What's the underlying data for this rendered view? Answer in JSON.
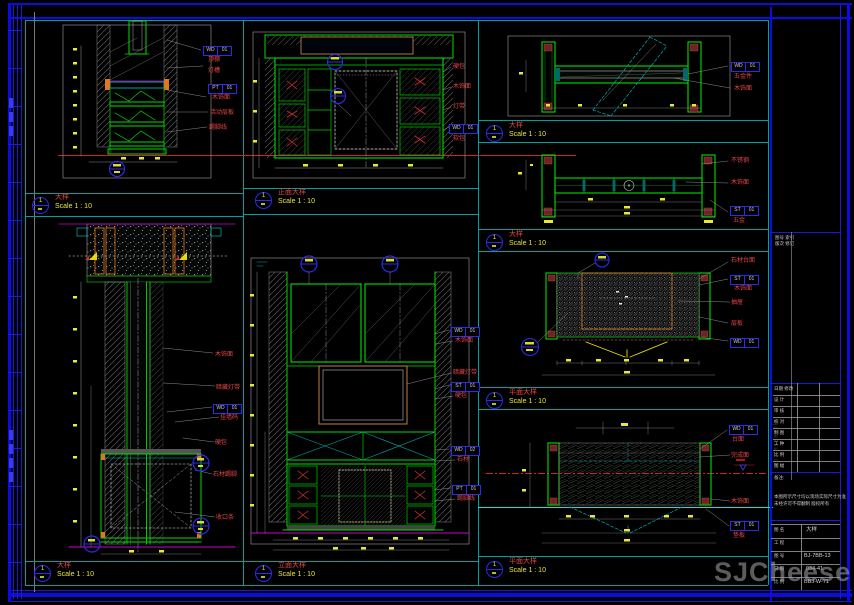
{
  "watermark": {
    "text": "SJCheese",
    "vertical_text": "sjcheese.com"
  },
  "drawings": {
    "d1": {
      "num": "1",
      "title": "大样",
      "scale": "Scale 1 : 10",
      "annotations": [
        "顶棚",
        "灯槽",
        "木饰面",
        "活动层板",
        "踢脚线"
      ],
      "tags": [
        [
          "WD",
          "01"
        ],
        [
          "PT",
          "01"
        ]
      ]
    },
    "d2": {
      "num": "1",
      "title": "大样",
      "scale": "Scale 1 : 10",
      "annotations": [
        "木饰面",
        "暗藏灯带",
        "挂墙码",
        "硬包",
        "石材踢脚",
        "收口条"
      ],
      "tags": [
        [
          "WD",
          "01"
        ]
      ]
    },
    "d3": {
      "num": "1",
      "title": "正面大样",
      "scale": "Scale 1 : 10",
      "annotations": [
        "硬包",
        "木饰面",
        "灯带",
        "软包"
      ],
      "tags": [
        [
          "WD",
          "01"
        ]
      ]
    },
    "d4": {
      "num": "1",
      "title": "立面大样",
      "scale": "Scale 1 : 10",
      "annotations": [
        "木饰面",
        "暗藏灯带",
        "硬包",
        "石材",
        "踢脚线"
      ],
      "tags": [
        [
          "WD",
          "01"
        ],
        [
          "ST",
          "01"
        ],
        [
          "WD",
          "02"
        ],
        [
          "PT",
          "01"
        ]
      ]
    },
    "d5": {
      "num": "1",
      "title": "大样",
      "scale": "Scale 1 : 10",
      "annotations": [
        "五金件",
        "木饰面"
      ],
      "tags": [
        [
          "WD",
          "01"
        ]
      ]
    },
    "d6": {
      "num": "1",
      "title": "大样",
      "scale": "Scale 1 : 10",
      "annotations": [
        "不锈钢",
        "木饰面",
        "五金"
      ],
      "tags": [
        [
          "ST",
          "01"
        ]
      ]
    },
    "d7": {
      "num": "1",
      "title": "平面大样",
      "scale": "Scale 1 : 10",
      "annotations": [
        "石材台面",
        "木饰面",
        "抽屉",
        "层板"
      ],
      "tags": [
        [
          "ST",
          "01"
        ],
        [
          "WD",
          "01"
        ]
      ]
    },
    "d8": {
      "num": "1",
      "title": "平面大样",
      "scale": "Scale 1 : 10",
      "annotations": [
        "台面",
        "完成面",
        "木饰面",
        "垫板"
      ],
      "tags": [
        [
          "WD",
          "01"
        ],
        [
          "ST",
          "01"
        ]
      ]
    }
  },
  "title_block": {
    "header_small": [
      "图号 索引",
      "版次 修订"
    ],
    "rev_rows": [
      "日期 修改",
      "设 计",
      "审 核",
      "校 对",
      "制 图",
      "工 种",
      "比 例",
      "图 幅"
    ],
    "note_title": "备注:",
    "desc_lines": [
      "本图所示尺寸均以现场实际尺寸为准",
      "未经许可不得翻制 版权所有"
    ],
    "info_rows": [
      {
        "label": "图 名",
        "value": "大样"
      },
      {
        "label": "工 程",
        "value": ""
      },
      {
        "label": "图 号",
        "value": "BJ-7BB-13"
      },
      {
        "label": "日 期",
        "value": "034-41"
      },
      {
        "label": "比 例",
        "value": "BBJ-W-71"
      },
      {
        "label": "页 次",
        "value": ""
      }
    ]
  }
}
